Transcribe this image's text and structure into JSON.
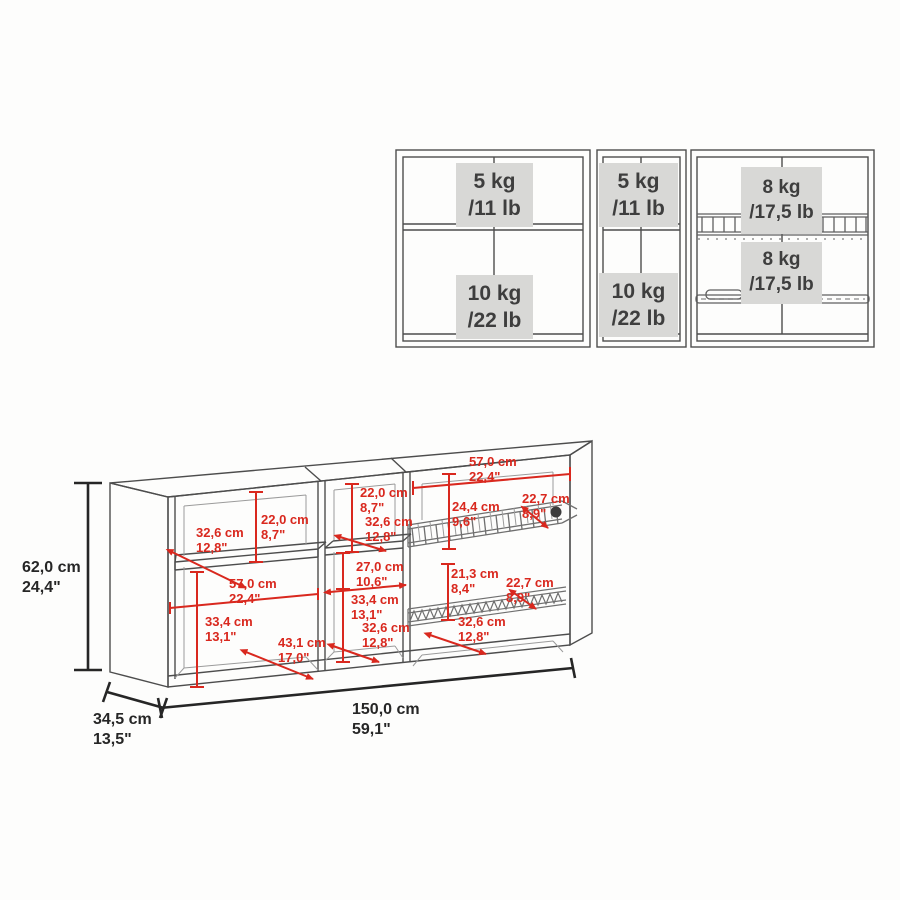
{
  "colors": {
    "background": "#fdfdfc",
    "cabinet_line": "#4d4d4d",
    "interior_line": "#9b9b9b",
    "dimension_red": "#d9281e",
    "dimension_black": "#262626",
    "badge_background": "#d8d8d6",
    "badge_text": "#3e3e3e"
  },
  "load_view": {
    "badges": [
      {
        "weight": "5 kg",
        "alt": "/11 lb"
      },
      {
        "weight": "10 kg",
        "alt": "/22 lb"
      },
      {
        "weight": "5 kg",
        "alt": "/11 lb"
      },
      {
        "weight": "10 kg",
        "alt": "/22 lb"
      },
      {
        "weight": "8 kg",
        "alt": "/17,5 lb"
      },
      {
        "weight": "8 kg",
        "alt": "/17,5 lb"
      }
    ]
  },
  "dimension_view": {
    "overall": {
      "height": {
        "cm": "62,0 cm",
        "inch": "24,4\""
      },
      "depth": {
        "cm": "34,5 cm",
        "inch": "13,5\""
      },
      "width": {
        "cm": "150,0 cm",
        "inch": "59,1\""
      }
    },
    "left_section": {
      "shelf_depth": {
        "cm": "32,6 cm",
        "inch": "12,8\""
      },
      "upper_height": {
        "cm": "22,0 cm",
        "inch": "8,7\""
      },
      "inner_width": {
        "cm": "57,0 cm",
        "inch": "22,4\""
      },
      "lower_height": {
        "cm": "33,4 cm",
        "inch": "13,1\""
      },
      "lower_diagonal": {
        "cm": "43,1 cm",
        "inch": "17,0\""
      }
    },
    "center_section": {
      "upper_height": {
        "cm": "22,0 cm",
        "inch": "8,7\""
      },
      "shelf_depth": {
        "cm": "32,6 cm",
        "inch": "12,8\""
      },
      "inner_width": {
        "cm": "27,0 cm",
        "inch": "10,6\""
      },
      "lower_height": {
        "cm": "33,4 cm",
        "inch": "13,1\""
      },
      "lower_depth": {
        "cm": "32,6 cm",
        "inch": "12,8\""
      }
    },
    "right_section": {
      "inner_width": {
        "cm": "57,0 cm",
        "inch": "22,4\""
      },
      "upper_rack_height": {
        "cm": "24,4 cm",
        "inch": "9,6\""
      },
      "upper_rack_depth": {
        "cm": "22,7 cm",
        "inch": "8,9\""
      },
      "lower_rack_height": {
        "cm": "21,3 cm",
        "inch": "8,4\""
      },
      "lower_rack_depth": {
        "cm": "22,7 cm",
        "inch": "8,9\""
      },
      "lower_depth": {
        "cm": "32,6 cm",
        "inch": "12,8\""
      }
    }
  }
}
